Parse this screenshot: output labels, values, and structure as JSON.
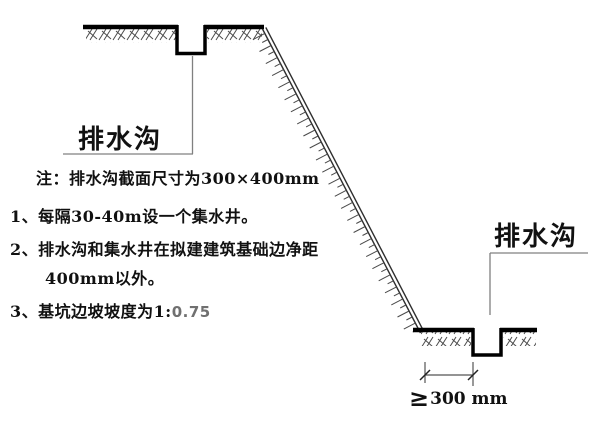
{
  "labels": {
    "drain_top": "排水沟",
    "drain_bottom": "排水沟"
  },
  "dimension": {
    "symbol": "≥",
    "value": "300 mm"
  },
  "notes": {
    "title": "注：排水沟截面尺寸为300×400mm",
    "item1": "1、每隔30-40m设一个集水井。",
    "item2_line1": "2、排水沟和集水井在拟建建筑基础边净距",
    "item2_line2": "400mm以外。",
    "item3_prefix": "3、基坑边坡坡度为1:",
    "item3_value": "0.75"
  },
  "colors": {
    "ground_line": "#000000",
    "slope_line": "#2e2e2e",
    "hatch": "#4a4a4a",
    "leader": "#808080",
    "dimension": "#555555",
    "text": "#111111",
    "muted_value": "#707070"
  }
}
